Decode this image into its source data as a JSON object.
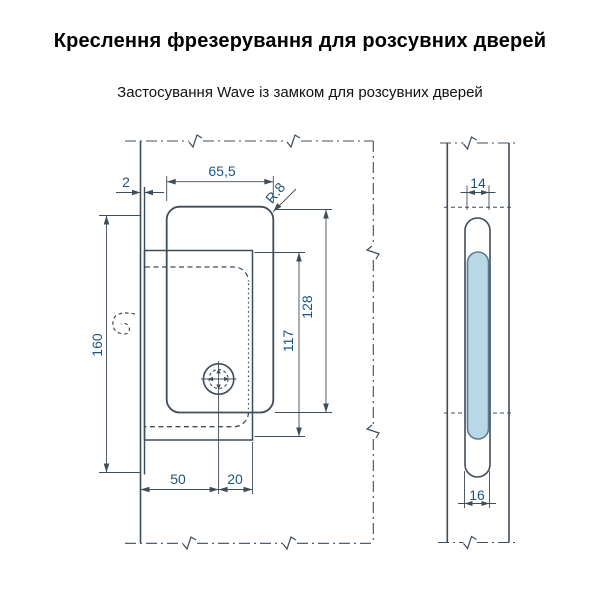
{
  "header": {
    "title": "Креслення фрезерування для розсувних дверей",
    "subtitle": "Застосування Wave із замком для розсувних дверей"
  },
  "front_view": {
    "dims": {
      "edge_offset": "2",
      "pocket_width": "65,5",
      "corner_radius": "R.8",
      "recess_height": "160",
      "faceplate_height": "117",
      "pocket_height": "128",
      "backset": "50",
      "center_offset": "20"
    }
  },
  "side_view": {
    "dims": {
      "slot_width_top": "14",
      "slot_width_bottom": "16"
    }
  },
  "colors": {
    "drawing_line": "#3f4c59",
    "dimension_text": "#1d5581",
    "slot_fill": "#b9d8e6"
  }
}
